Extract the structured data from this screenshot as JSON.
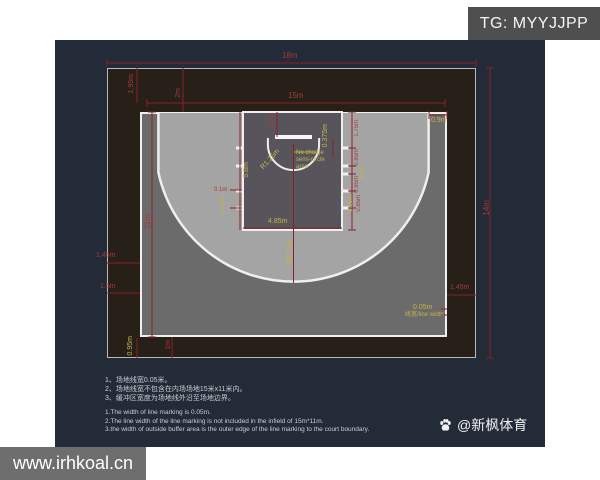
{
  "header": {
    "tg_label": "TG: MYYJJPP"
  },
  "footer": {
    "site": "www.irhkoal.cn",
    "credit": "@新枫体育"
  },
  "colors": {
    "panel_bg": "#222b37",
    "buffer_bg": "#272019",
    "court_dark": "#6b6b6b",
    "court_light": "#a4a4a4",
    "key_fill": "#57555b",
    "line_white": "#efefef",
    "dim_red": "#8b2126",
    "label_red": "#a33a3c",
    "label_yellow": "#c5b34a",
    "tg_bg": "#4f4f4f",
    "watermark_bg": "#6e6e6e"
  },
  "court": {
    "dims": {
      "overall_width": "18m",
      "overall_height": "14m",
      "infield_width": "15m",
      "infield_height": "11m",
      "top_buffer_inner": "1.95m",
      "top_buffer": "2m",
      "side_buffer_inner_left": "1.45m",
      "side_buffer_left": "1.5m",
      "side_buffer_inner_right": "1.45m",
      "bottom_buffer": "1m",
      "bottom_buffer_inner": "0.95m",
      "corner_three_point": "0.9m",
      "backboard_offset": "1.2m",
      "board_to_basket": "0.375m",
      "no_charge_radius": "R1.25m",
      "no_charge_lines": [
        "No charge",
        "semi-circle",
        "area"
      ],
      "key_height": "5.8m",
      "key_width": "4.85m",
      "three_point_radius": "R6.75m",
      "lane_marks": [
        "1.75m",
        "0.85m",
        "0.4m",
        "0.85m",
        "0.05m",
        "0.85m"
      ],
      "hash_depth": "0.1m",
      "hash_line": "0.05m",
      "line_width": "0.05m",
      "line_width_note": "线宽/line width"
    }
  },
  "notes": {
    "zh": [
      "1、场地线宽0.05米。",
      "2、场地线宽不包含在内场场地15米x11米内。",
      "3、缓冲区宽度为场地线外沿至场地边界。"
    ],
    "en": [
      "1.The width of line marking is 0.05m.",
      "2.The line width of the line marking is not included in the infield of 15m*11m.",
      "3.the width of outside buffer area is the outer edge of the line marking to the court boundary."
    ]
  }
}
